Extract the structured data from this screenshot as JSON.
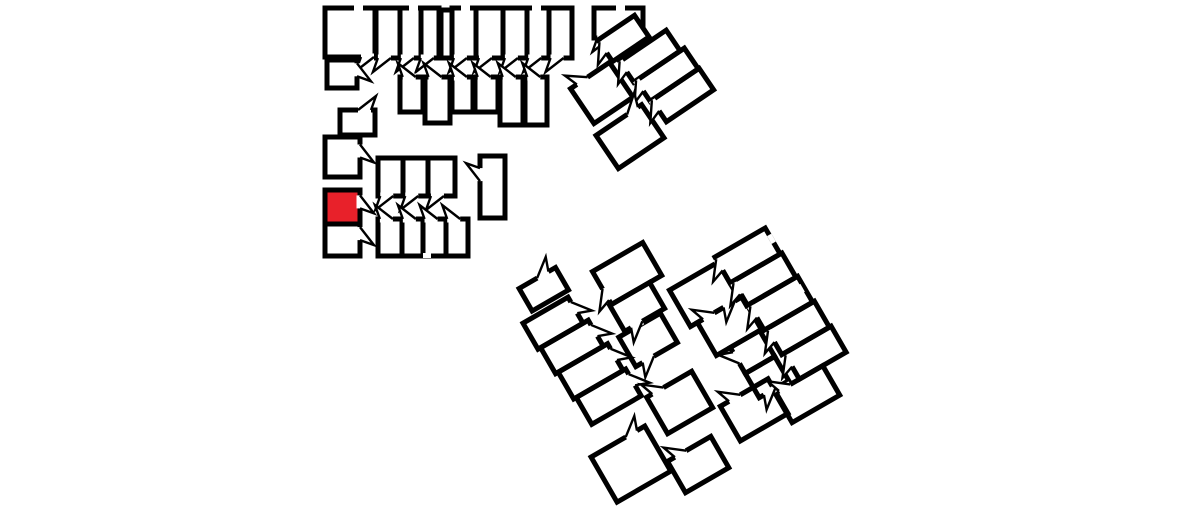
{
  "canvas": {
    "width": 1184,
    "height": 529,
    "background": "#ffffff"
  },
  "style": {
    "wall_color": "#000000",
    "room_fill": "#ffffff",
    "highlight_color": "#e8212a",
    "wall_width": 5,
    "door_stroke": 2.4,
    "door_gap": 13,
    "door_depth": 14,
    "hinge_offset": 5
  },
  "highlighted_room": {
    "id": "C3",
    "cluster": "west-wing",
    "color": "#e8212a"
  },
  "floorplan": {
    "clusters": [
      {
        "id": "west-wing",
        "rotation": 0,
        "pivot": [
          0,
          0
        ],
        "rooms": [
          {
            "id": "A1",
            "x": 325,
            "y": 8,
            "w": 50,
            "h": 49,
            "doors": [
              {
                "s": "bottom",
                "t": 0.85,
                "d": -1
              }
            ]
          },
          {
            "id": "A2",
            "x": 327,
            "y": 60,
            "w": 30,
            "h": 28,
            "doors": [
              {
                "s": "right",
                "t": 0.35,
                "d": 1
              }
            ]
          },
          {
            "id": "A3",
            "x": 376,
            "y": 8,
            "w": 24,
            "h": 50,
            "doors": [
              {
                "s": "bottom",
                "t": 0.35,
                "d": -1
              }
            ]
          },
          {
            "id": "A4",
            "x": 400,
            "y": 8,
            "w": 21,
            "h": 50,
            "doors": [
              {
                "s": "bottom",
                "t": 0.35,
                "d": -1
              }
            ]
          },
          {
            "id": "A5",
            "x": 421,
            "y": 8,
            "w": 18,
            "h": 50,
            "doors": [
              {
                "s": "bottom",
                "t": 0.35,
                "d": -1
              }
            ]
          },
          {
            "id": "A5b",
            "x": 441,
            "y": 10,
            "w": 11,
            "h": 48,
            "doors": []
          },
          {
            "id": "A6",
            "x": 452,
            "y": 8,
            "w": 24,
            "h": 50,
            "doors": [
              {
                "s": "bottom",
                "t": 0.35,
                "d": -1
              }
            ]
          },
          {
            "id": "A7",
            "x": 476,
            "y": 8,
            "w": 27,
            "h": 50,
            "doors": [
              {
                "s": "bottom",
                "t": 0.35,
                "d": -1
              }
            ]
          },
          {
            "id": "A8",
            "x": 503,
            "y": 8,
            "w": 24,
            "h": 50,
            "doors": [
              {
                "s": "bottom",
                "t": 0.35,
                "d": -1
              }
            ]
          },
          {
            "id": "A9",
            "x": 527,
            "y": 8,
            "w": 22,
            "h": 50,
            "doors": [
              {
                "s": "bottom",
                "t": 0.35,
                "d": -1
              }
            ]
          },
          {
            "id": "A10",
            "x": 549,
            "y": 8,
            "w": 23,
            "h": 50,
            "doors": [
              {
                "s": "bottom",
                "t": 0.35,
                "d": -1
              }
            ]
          },
          {
            "id": "B1",
            "x": 400,
            "y": 77,
            "w": 23,
            "h": 35,
            "doors": [
              {
                "s": "top",
                "t": 0.4,
                "d": -1
              }
            ]
          },
          {
            "id": "B2",
            "x": 425,
            "y": 77,
            "w": 25,
            "h": 46,
            "doors": [
              {
                "s": "top",
                "t": 0.4,
                "d": -1
              }
            ]
          },
          {
            "id": "B3",
            "x": 452,
            "y": 77,
            "w": 21,
            "h": 35,
            "doors": [
              {
                "s": "top",
                "t": 0.4,
                "d": -1
              }
            ]
          },
          {
            "id": "B4",
            "x": 475,
            "y": 77,
            "w": 23,
            "h": 35,
            "doors": [
              {
                "s": "top",
                "t": 0.4,
                "d": -1
              }
            ]
          },
          {
            "id": "B5",
            "x": 500,
            "y": 77,
            "w": 23,
            "h": 48,
            "doors": [
              {
                "s": "top",
                "t": 0.4,
                "d": -1
              }
            ]
          },
          {
            "id": "B6",
            "x": 525,
            "y": 77,
            "w": 22,
            "h": 48,
            "doors": [
              {
                "s": "top",
                "t": 0.4,
                "d": -1
              }
            ]
          },
          {
            "id": "C1",
            "x": 340,
            "y": 110,
            "w": 35,
            "h": 25,
            "doors": [
              {
                "s": "top",
                "t": 0.7,
                "d": 1
              }
            ]
          },
          {
            "id": "C2",
            "x": 325,
            "y": 137,
            "w": 35,
            "h": 40,
            "doors": [
              {
                "s": "right",
                "t": 0.35,
                "d": 1
              }
            ]
          },
          {
            "id": "C3",
            "x": 325,
            "y": 190,
            "w": 35,
            "h": 34,
            "highlight": true,
            "doors": [
              {
                "s": "right",
                "t": 0.35,
                "d": 1
              }
            ]
          },
          {
            "id": "C4",
            "x": 325,
            "y": 224,
            "w": 35,
            "h": 32,
            "doors": [
              {
                "s": "right",
                "t": 0.3,
                "d": 1
              }
            ]
          },
          {
            "id": "D1",
            "x": 378,
            "y": 158,
            "w": 25,
            "h": 38,
            "doors": [
              {
                "s": "bottom",
                "t": 0.35,
                "d": -1
              }
            ]
          },
          {
            "id": "D2",
            "x": 403,
            "y": 158,
            "w": 25,
            "h": 38,
            "doors": [
              {
                "s": "bottom",
                "t": 0.35,
                "d": -1
              }
            ]
          },
          {
            "id": "D3",
            "x": 428,
            "y": 158,
            "w": 27,
            "h": 38,
            "doors": [
              {
                "s": "bottom",
                "t": 0.35,
                "d": -1
              }
            ]
          },
          {
            "id": "E1",
            "x": 378,
            "y": 219,
            "w": 24,
            "h": 37,
            "doors": [
              {
                "s": "top",
                "t": 0.35,
                "d": -1
              }
            ]
          },
          {
            "id": "E2",
            "x": 402,
            "y": 219,
            "w": 21,
            "h": 37,
            "doors": [
              {
                "s": "top",
                "t": 0.35,
                "d": -1
              }
            ]
          },
          {
            "id": "E3",
            "x": 423,
            "y": 219,
            "w": 23,
            "h": 37,
            "doors": [
              {
                "s": "top",
                "t": 0.35,
                "d": -1
              }
            ]
          },
          {
            "id": "E4",
            "x": 446,
            "y": 219,
            "w": 22,
            "h": 37,
            "doors": [
              {
                "s": "top",
                "t": 0.35,
                "d": -1
              }
            ]
          },
          {
            "id": "F1",
            "x": 480,
            "y": 156,
            "w": 25,
            "h": 62,
            "doors": [
              {
                "s": "left",
                "t": 0.3,
                "d": -1
              }
            ]
          },
          {
            "id": "R1",
            "x": 594,
            "y": 8,
            "w": 49,
            "h": 30,
            "doors": [
              {
                "s": "bottom",
                "t": 0.2,
                "d": -1
              }
            ]
          }
        ],
        "windows": [
          {
            "x": 354,
            "y": 5.5,
            "w": 9,
            "h": 5
          },
          {
            "x": 409,
            "y": 5.5,
            "w": 9,
            "h": 5
          },
          {
            "x": 461,
            "y": 5.5,
            "w": 9,
            "h": 5
          },
          {
            "x": 532,
            "y": 5.5,
            "w": 9,
            "h": 5
          },
          {
            "x": 616,
            "y": 5.5,
            "w": 9,
            "h": 5
          },
          {
            "x": 423,
            "y": 253,
            "w": 8,
            "h": 5
          }
        ]
      },
      {
        "id": "north-east-building",
        "rotation": -34,
        "pivot": [
          598,
          40
        ],
        "rooms": [
          {
            "id": "R2",
            "x": 0,
            "y": 0,
            "w": 44,
            "h": 26,
            "doors": [
              {
                "s": "left",
                "t": 0.35,
                "d": 1
              }
            ]
          },
          {
            "id": "S1",
            "x": 6,
            "y": 30,
            "w": 56,
            "h": 25,
            "doors": [
              {
                "s": "left",
                "t": 0.25,
                "d": 1
              }
            ]
          },
          {
            "id": "S2",
            "x": 9,
            "y": 55,
            "w": 58,
            "h": 25,
            "doors": [
              {
                "s": "left",
                "t": 0.25,
                "d": 1
              }
            ]
          },
          {
            "id": "S3",
            "x": 11,
            "y": 80,
            "w": 57,
            "h": 26,
            "doors": [
              {
                "s": "left",
                "t": 0.25,
                "d": 1
              }
            ]
          },
          {
            "id": "R5",
            "x": -50,
            "y": 25,
            "w": 47,
            "h": 42,
            "doors": [
              {
                "s": "top",
                "t": 0.3,
                "d": -1
              }
            ]
          },
          {
            "id": "R6",
            "x": -55,
            "y": 78,
            "w": 55,
            "h": 40,
            "doors": [
              {
                "s": "top",
                "t": 0.8,
                "d": 1
              }
            ]
          }
        ],
        "windows": []
      },
      {
        "id": "south-west-building",
        "rotation": -30,
        "pivot": [
          520,
          318
        ],
        "rooms": [
          {
            "id": "T1",
            "x": 14,
            "y": -26,
            "w": 42,
            "h": 26,
            "doors": [
              {
                "s": "top",
                "t": 0.65,
                "d": 1
              }
            ]
          },
          {
            "id": "L1",
            "x": 0,
            "y": 6,
            "w": 52,
            "h": 30,
            "doors": [
              {
                "s": "right",
                "t": 0.4,
                "d": 1
              }
            ]
          },
          {
            "id": "L2",
            "x": 3,
            "y": 36,
            "w": 55,
            "h": 30,
            "doors": [
              {
                "s": "right",
                "t": 0.4,
                "d": 1
              }
            ]
          },
          {
            "id": "L3",
            "x": 6,
            "y": 66,
            "w": 57,
            "h": 31,
            "doors": [
              {
                "s": "right",
                "t": 0.4,
                "d": 1
              }
            ]
          },
          {
            "id": "L4",
            "x": 9,
            "y": 97,
            "w": 57,
            "h": 31,
            "doors": [
              {
                "s": "right",
                "t": 0.4,
                "d": 1
              }
            ]
          },
          {
            "id": "R",
            "x": -8,
            "y": 156,
            "w": 62,
            "h": 52,
            "doors": [
              {
                "s": "top",
                "t": 0.75,
                "d": 1
              }
            ]
          },
          {
            "id": "M1",
            "x": 86,
            "y": -4,
            "w": 58,
            "h": 38,
            "doors": [
              {
                "s": "left",
                "t": 0.7,
                "d": 1
              }
            ]
          },
          {
            "id": "M2",
            "x": 84,
            "y": 34,
            "w": 46,
            "h": 30,
            "doors": [
              {
                "s": "bottom",
                "t": 0.3,
                "d": -1
              }
            ]
          },
          {
            "id": "M3",
            "x": 76,
            "y": 66,
            "w": 48,
            "h": 34,
            "doors": [
              {
                "s": "bottom",
                "t": 0.3,
                "d": -1
              }
            ]
          },
          {
            "id": "N1",
            "x": 70,
            "y": 132,
            "w": 52,
            "h": 42,
            "doors": [
              {
                "s": "top",
                "t": 0.25,
                "d": -1
              }
            ]
          },
          {
            "id": "N3",
            "x": 56,
            "y": 198,
            "w": 50,
            "h": 36,
            "doors": [
              {
                "s": "top",
                "t": 0.3,
                "d": -1
              }
            ]
          }
        ],
        "windows": []
      },
      {
        "id": "south-east-building",
        "rotation": -30,
        "pivot": [
          663,
          287
        ],
        "rooms": [
          {
            "id": "LB1",
            "x": 4,
            "y": 6,
            "w": 56,
            "h": 42,
            "doors": [
              {
                "s": "bottom",
                "t": 0.8,
                "d": -1
              }
            ]
          },
          {
            "id": "LB2",
            "x": 12,
            "y": 48,
            "w": 52,
            "h": 38,
            "doors": [
              {
                "s": "top",
                "t": 0.25,
                "d": -1
              }
            ]
          },
          {
            "id": "RS1",
            "x": 60,
            "y": 0,
            "w": 58,
            "h": 30,
            "doors": [
              {
                "s": "left",
                "t": 0.3,
                "d": 1
              }
            ]
          },
          {
            "id": "RS2",
            "x": 63,
            "y": 30,
            "w": 57,
            "h": 28,
            "doors": [
              {
                "s": "left",
                "t": 0.3,
                "d": 1
              }
            ]
          },
          {
            "id": "RS3",
            "x": 66,
            "y": 58,
            "w": 56,
            "h": 30,
            "doors": [
              {
                "s": "left",
                "t": 0.3,
                "d": 1
              }
            ]
          },
          {
            "id": "RS4",
            "x": 69,
            "y": 88,
            "w": 55,
            "h": 30,
            "doors": [
              {
                "s": "left",
                "t": 0.3,
                "d": 1
              }
            ]
          },
          {
            "id": "RS5",
            "x": 72,
            "y": 118,
            "w": 54,
            "h": 30,
            "doors": [
              {
                "s": "left",
                "t": 0.3,
                "d": 1
              }
            ]
          },
          {
            "id": "MS1",
            "x": 28,
            "y": 86,
            "w": 34,
            "h": 30,
            "doors": [
              {
                "s": "left",
                "t": 0.4,
                "d": -1
              }
            ]
          },
          {
            "id": "MS2",
            "x": 28,
            "y": 116,
            "w": 34,
            "h": 28,
            "doors": [
              {
                "s": "bottom",
                "t": 0.35,
                "d": -1
              }
            ]
          },
          {
            "id": "BB1",
            "x": -10,
            "y": 132,
            "w": 55,
            "h": 40,
            "doors": [
              {
                "s": "top",
                "t": 0.3,
                "d": -1
              }
            ]
          },
          {
            "id": "BB2",
            "x": 44,
            "y": 148,
            "w": 55,
            "h": 34,
            "doors": [
              {
                "s": "top",
                "t": 0.2,
                "d": -1
              }
            ]
          }
        ],
        "windows": [
          {
            "x": 115.5,
            "y": 8,
            "w": 5,
            "h": 9
          },
          {
            "x": 115.5,
            "y": 66,
            "w": 5,
            "h": 9
          },
          {
            "x": 115.5,
            "y": 124,
            "w": 5,
            "h": 9
          }
        ]
      }
    ]
  }
}
